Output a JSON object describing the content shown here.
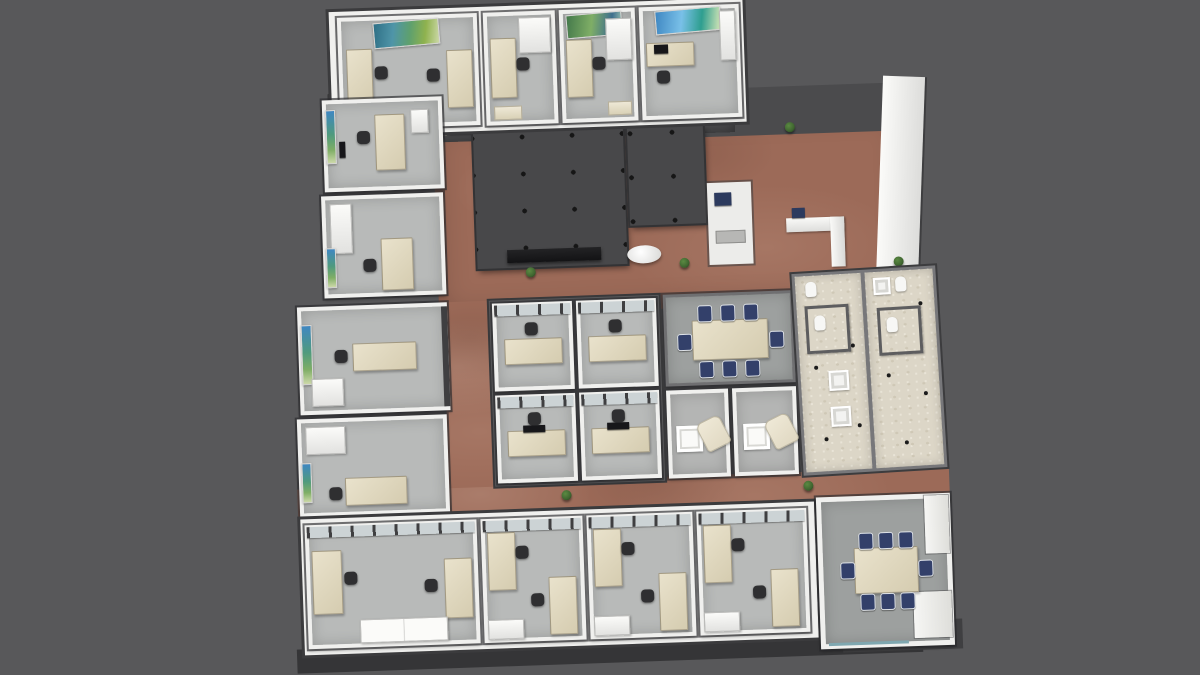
{
  "scene": {
    "description": "3D rendered top-down perspective view of an office building floor plan",
    "render_style": "architectural visualization, no on-screen text or UI chrome"
  },
  "colors": {
    "background": "#58585a",
    "exterior-wall": "#3b3b3d",
    "interior-wall": "#f0f0ee",
    "office-carpet": "#b8bab9",
    "conference-carpet": "#9da09f",
    "corridor-floor": "#9c6a58",
    "lobby-dark-wall": "#4b4b4d",
    "core-roof": "#48484a",
    "core-dot": "#161616",
    "desk": "#d5ccb0",
    "desk-light": "#e9e2cc",
    "chair-dark": "#2f2f31",
    "chair-navy": "#33406a",
    "cabinet": "#f4f4f2",
    "restroom-floor": "#dcd6c7",
    "restroom-partition": "#5d5d5f",
    "armchair": "#e0d8c2",
    "plant": "#3f6530",
    "bottom-band": "#262628",
    "bottom-apron": "#353537",
    "glass-frame": "#3f3f41",
    "glass-pane": "#ccd3d5",
    "monitor": "#17171a"
  },
  "inventory": {
    "rooms": [
      {
        "id": "private-office-1",
        "type": "private office",
        "furniture": [
          "desk x2",
          "task chair x2",
          "landscape wall art",
          "low cabinet"
        ]
      },
      {
        "id": "private-office-2",
        "type": "private office",
        "furniture": [
          "desk",
          "task chair",
          "storage cabinet",
          "bench"
        ]
      },
      {
        "id": "private-office-3",
        "type": "private office",
        "furniture": [
          "desk",
          "task chair",
          "storage cabinet",
          "landscape wall art",
          "bench"
        ]
      },
      {
        "id": "private-office-4",
        "type": "private office",
        "furniture": [
          "desk",
          "laptop",
          "task chair",
          "tall cabinet",
          "landscape wall art"
        ]
      },
      {
        "id": "private-office-5",
        "type": "private office",
        "furniture": [
          "desk",
          "task chair",
          "pedestal",
          "wall art",
          "wall display"
        ]
      },
      {
        "id": "private-office-6",
        "type": "private office",
        "furniture": [
          "desk",
          "task chair",
          "tall cabinet",
          "wall art"
        ]
      },
      {
        "id": "elevator-lobby",
        "type": "circulation",
        "furniture": [
          "elevator door x4",
          "floor mat x3",
          "plant"
        ]
      },
      {
        "id": "service-core-1",
        "type": "service core",
        "furniture": [
          "roof plenum with fixture grid",
          "media counter"
        ]
      },
      {
        "id": "service-core-2",
        "type": "service core",
        "furniture": [
          "roof plenum"
        ]
      },
      {
        "id": "copy-alcove",
        "type": "alcove",
        "furniture": [
          "printer",
          "work table"
        ]
      },
      {
        "id": "reception-lobby",
        "type": "lobby",
        "furniture": [
          "reception desk",
          "monitor",
          "round table",
          "plant x4",
          "terracotta tile floor"
        ]
      },
      {
        "id": "private-office-7",
        "type": "private office",
        "furniture": [
          "desk",
          "task chair",
          "pedestal",
          "wall art"
        ]
      },
      {
        "id": "private-office-8",
        "type": "private office",
        "furniture": [
          "desk",
          "task chair",
          "storage cabinet",
          "wall art"
        ]
      },
      {
        "id": "workstation-1",
        "type": "open cubicle",
        "furniture": [
          "desk",
          "task chair",
          "glazed front"
        ]
      },
      {
        "id": "workstation-2",
        "type": "open cubicle",
        "furniture": [
          "desk",
          "task chair",
          "glazed front"
        ]
      },
      {
        "id": "workstation-3",
        "type": "open cubicle",
        "furniture": [
          "desk",
          "monitor",
          "task chair",
          "glazed front"
        ]
      },
      {
        "id": "workstation-4",
        "type": "open cubicle",
        "furniture": [
          "desk",
          "monitor",
          "task chair",
          "glazed front"
        ]
      },
      {
        "id": "conference-room-a",
        "type": "conference room",
        "furniture": [
          "conference table",
          "navy conference chair x8"
        ]
      },
      {
        "id": "huddle-room-1",
        "type": "huddle room",
        "furniture": [
          "side table",
          "lounge chair"
        ]
      },
      {
        "id": "huddle-room-2",
        "type": "huddle room",
        "furniture": [
          "side table",
          "lounge chair"
        ]
      },
      {
        "id": "restroom-1",
        "type": "restroom",
        "furniture": [
          "toilet x2",
          "sink x2",
          "stall partition",
          "floor drain x4"
        ]
      },
      {
        "id": "restroom-2",
        "type": "restroom",
        "furniture": [
          "toilet x2",
          "sink",
          "stall partition",
          "floor drain x4"
        ]
      },
      {
        "id": "private-office-9",
        "type": "private office",
        "furniture": [
          "desk x2",
          "task chair x2",
          "credenza"
        ]
      },
      {
        "id": "private-office-10",
        "type": "private office",
        "furniture": [
          "desk x2",
          "task chair x2",
          "cabinet"
        ]
      },
      {
        "id": "private-office-11",
        "type": "private office",
        "furniture": [
          "desk x2",
          "task chair x2",
          "cabinet"
        ]
      },
      {
        "id": "private-office-12",
        "type": "private office",
        "furniture": [
          "desk x2",
          "task chair x2",
          "cabinet"
        ]
      },
      {
        "id": "conference-room-b",
        "type": "conference room",
        "furniture": [
          "conference table",
          "navy conference chair x8"
        ]
      }
    ]
  }
}
